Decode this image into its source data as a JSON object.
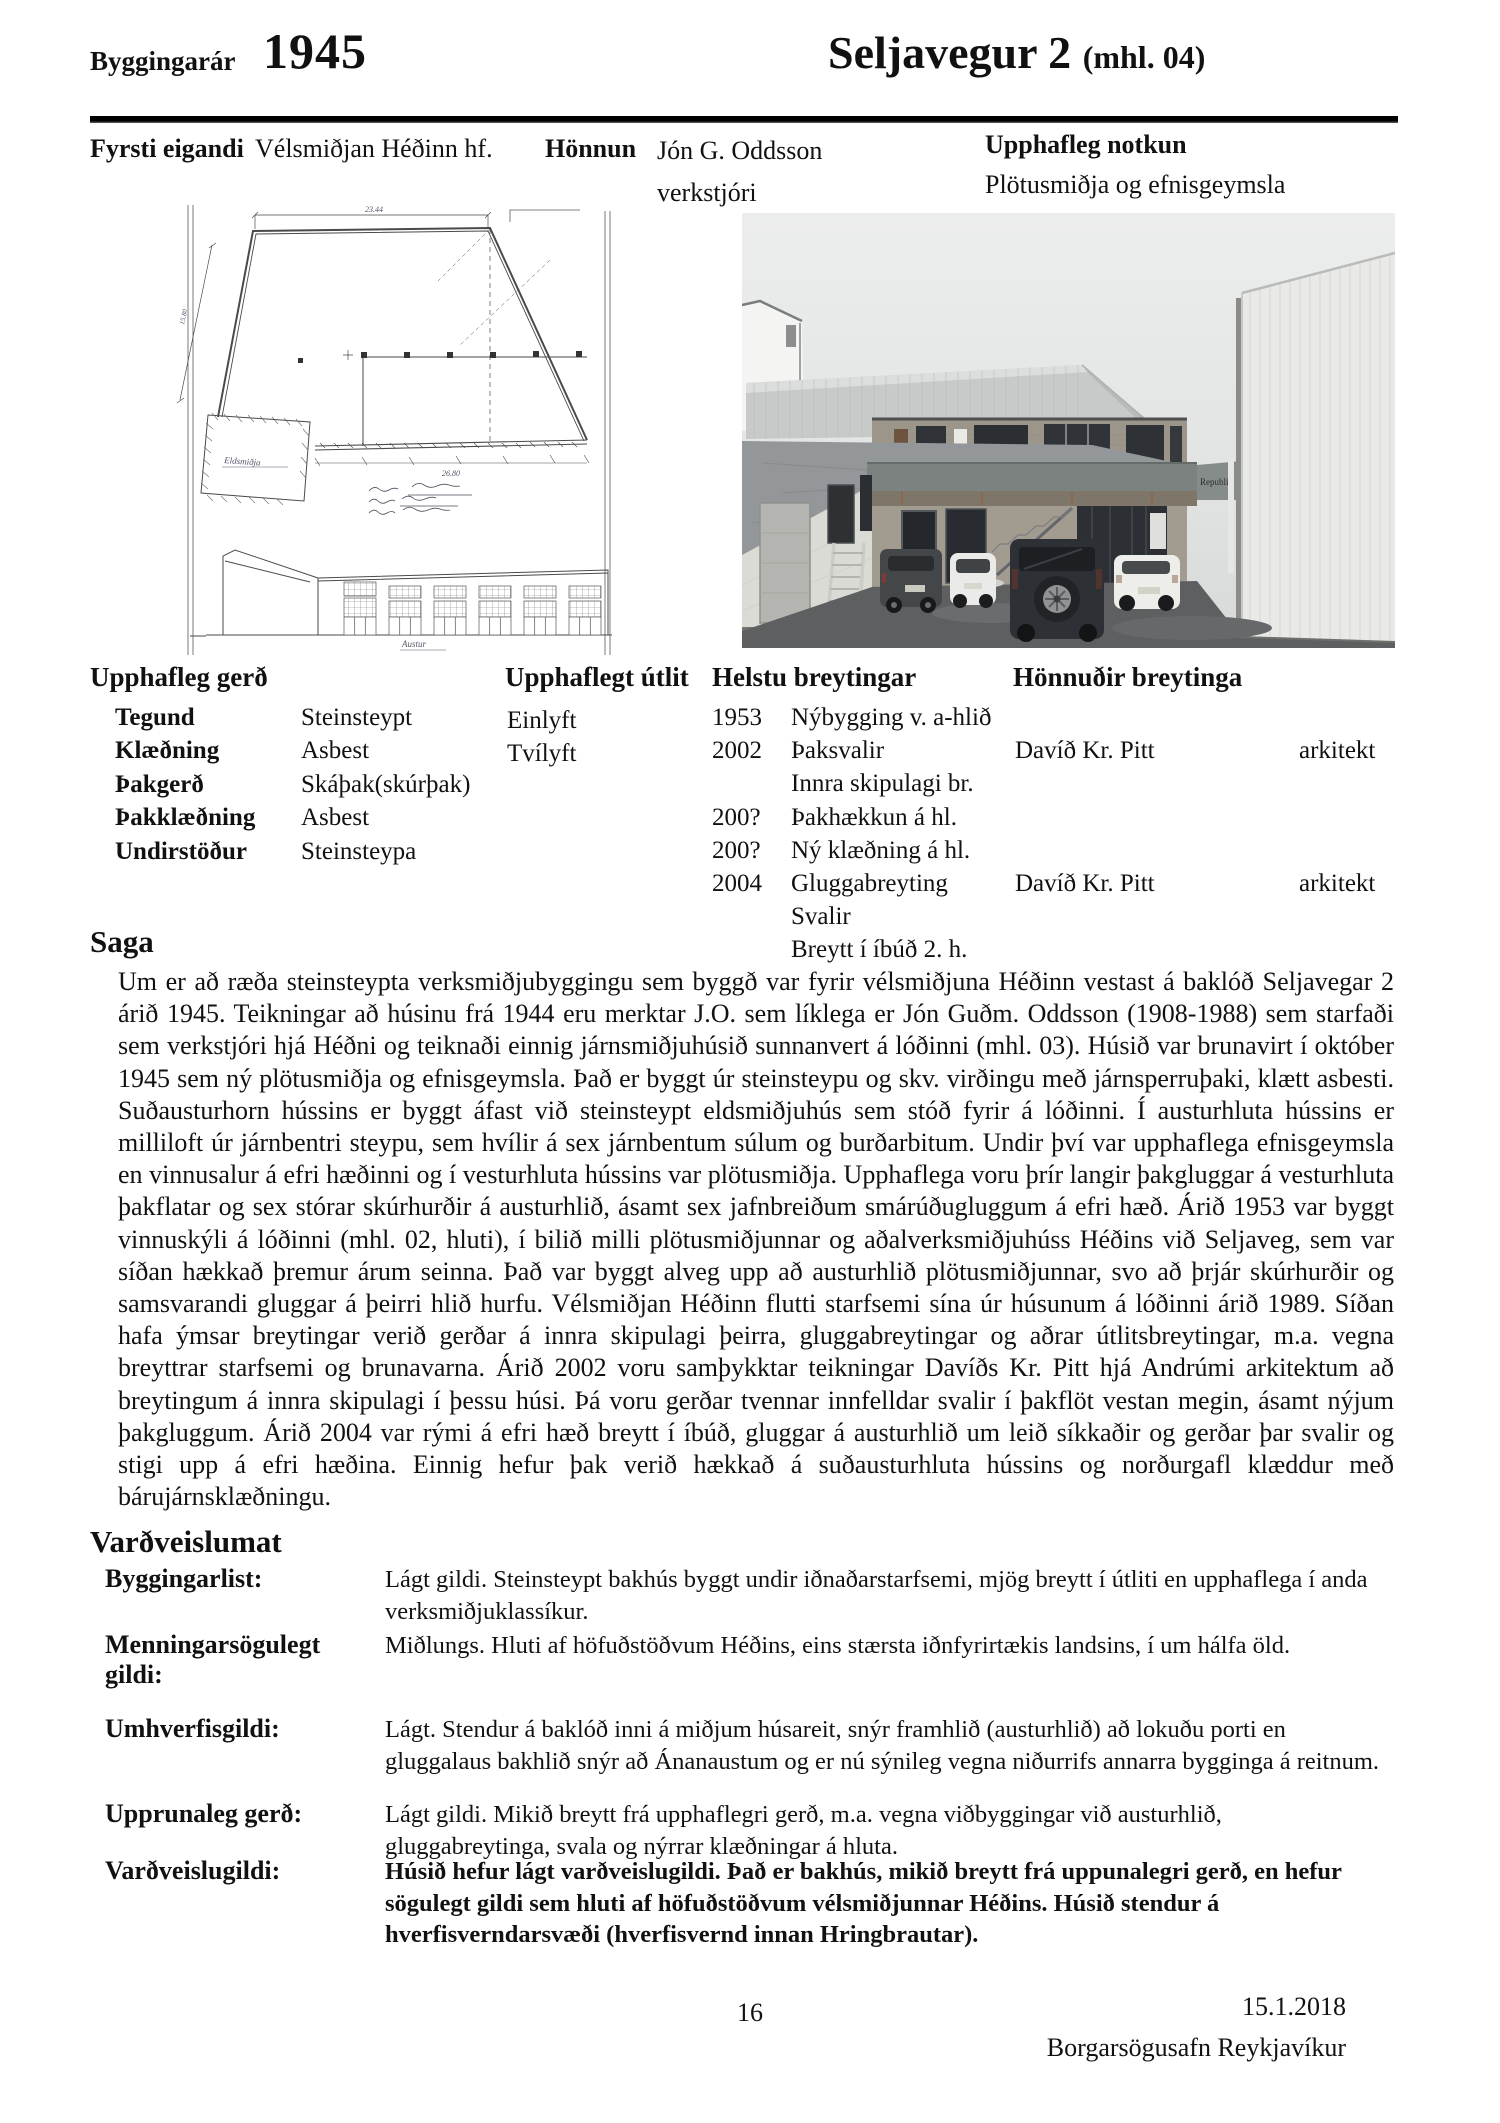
{
  "header": {
    "year_label": "Byggingarár",
    "year": "1945",
    "title": "Seljavegur 2",
    "title_suffix": "(mhl. 04)"
  },
  "info_row": {
    "first_owner_label": "Fyrsti eigandi",
    "first_owner": "Vélsmiðjan Héðinn hf.",
    "design_label": "Hönnun",
    "designer": "Jón G. Oddsson",
    "designer_title": "verkstjóri",
    "original_use_label": "Upphafleg notkun",
    "original_use": "Plötusmiðja og efnisgeymsla"
  },
  "media": {
    "drawing": {
      "top_dimension": "23.44",
      "bottom_dimension": "26.80",
      "side_dimension": "15.80",
      "smithy_label": "Eldsmiðja",
      "elevation_label": "Austur"
    },
    "photo": {
      "sign_text": "Republik"
    }
  },
  "original_form": {
    "heading": "Upphafleg gerð",
    "fields": [
      {
        "label": "Tegund",
        "value": "Steinsteypt"
      },
      {
        "label": "Klæðning",
        "value": "Asbest"
      },
      {
        "label": "Þakgerð",
        "value": "Skáþak(skúrþak)"
      },
      {
        "label": "Þakklæðning",
        "value": "Asbest"
      },
      {
        "label": "Undirstöður",
        "value": "Steinsteypa"
      }
    ]
  },
  "original_appearance": {
    "heading": "Upphaflegt útlit",
    "items": [
      "Einlyft",
      "Tvílyft"
    ]
  },
  "main_changes": {
    "heading": "Helstu breytingar",
    "designers_heading": "Hönnuðir breytinga",
    "rows": [
      {
        "year": "1953",
        "change": "Nýbygging v. a-hlið",
        "designer": "",
        "role": ""
      },
      {
        "year": "2002",
        "change": "Þaksvalir",
        "designer": "Davíð Kr. Pitt",
        "role": "arkitekt"
      },
      {
        "year": "",
        "change": "Innra skipulagi br.",
        "designer": "",
        "role": ""
      },
      {
        "year": "200?",
        "change": "Þakhækkun á hl.",
        "designer": "",
        "role": ""
      },
      {
        "year": "200?",
        "change": "Ný klæðning á hl.",
        "designer": "",
        "role": ""
      },
      {
        "year": "2004",
        "change": "Gluggabreyting",
        "designer": "Davíð Kr. Pitt",
        "role": "arkitekt"
      },
      {
        "year": "",
        "change": "Svalir",
        "designer": "",
        "role": ""
      },
      {
        "year": "",
        "change": "Breytt í íbúð 2. h.",
        "designer": "",
        "role": ""
      }
    ]
  },
  "saga": {
    "heading": "Saga",
    "text": "Um er að ræða steinsteypta verksmiðjubyggingu sem byggð var fyrir vélsmiðjuna Héðinn vestast á baklóð Seljavegar 2 árið 1945. Teikningar að húsinu frá 1944 eru merktar J.O. sem líklega er Jón Guðm. Oddsson (1908-1988) sem starfaði sem verkstjóri hjá Héðni og teiknaði einnig járnsmiðjuhúsið sunnanvert á lóðinni (mhl. 03). Húsið var brunavirt í október 1945 sem ný plötusmiðja og efnisgeymsla. Það er byggt úr steinsteypu og skv. virðingu með járnsperruþaki, klætt asbesti. Suðausturhorn hússins er byggt áfast við steinsteypt eldsmiðjuhús sem stóð fyrir á lóðinni. Í austurhluta hússins er milliloft úr járnbentri steypu, sem hvílir á sex járnbentum súlum og burðarbitum. Undir því var upphaflega efnisgeymsla en vinnusalur á efri hæðinni og í vesturhluta hússins var plötusmiðja. Upphaflega voru þrír langir þakgluggar á vesturhluta þakflatar og sex stórar skúrhurðir á austurhlið, ásamt sex jafnbreiðum smárúðugluggum á efri hæð. Árið 1953 var byggt vinnuskýli á lóðinni (mhl. 02, hluti), í bilið milli plötusmiðjunnar og aðalverksmiðjuhúss Héðins við Seljaveg, sem var síðan hækkað þremur árum seinna. Það var byggt alveg upp að austurhlið plötusmiðjunnar, svo að þrjár skúrhurðir og samsvarandi gluggar á þeirri hlið hurfu. Vélsmiðjan Héðinn flutti starfsemi sína úr húsunum á lóðinni árið 1989. Síðan hafa ýmsar breytingar verið gerðar á innra skipulagi þeirra, gluggabreytingar og aðrar útlitsbreytingar, m.a. vegna breyttrar starfsemi og brunavarna. Árið 2002 voru samþykktar teikningar Davíðs Kr. Pitt hjá Andrúmi arkitektum að breytingum á innra skipulagi í þessu húsi. Þá voru gerðar tvennar innfelldar svalir í þakflöt vestan megin, ásamt nýjum þakgluggum. Árið 2004 var rými á efri hæð breytt í íbúð, gluggar á austurhlið um leið síkkaðir og gerðar þar svalir og stigi upp á efri hæðina. Einnig hefur þak verið hækkað á suðausturhluta hússins og norðurgafl klæddur með bárujárnsklæðningu."
  },
  "assessment": {
    "heading": "Varðveislumat",
    "rows": [
      {
        "label": "Byggingarlist:",
        "text": "Lágt gildi. Steinsteypt bakhús byggt undir iðnaðarstarfsemi, mjög breytt í útliti en upphaflega í anda verksmiðjuklassíkur."
      },
      {
        "label": "Menningarsögulegt gildi:",
        "text": "Miðlungs. Hluti af höfuðstöðvum Héðins, eins stærsta iðnfyrirtækis landsins, í um hálfa öld."
      },
      {
        "label": "Umhverfisgildi:",
        "text": "Lágt. Stendur á baklóð inni á miðjum húsareit, snýr framhlið (austurhlið) að lokuðu porti en gluggalaus bakhlið snýr að Ánanaustum og er nú sýnileg vegna niðurrifs annarra bygginga á reitnum."
      },
      {
        "label": "Upprunaleg gerð:",
        "text": "Lágt gildi. Mikið breytt frá upphaflegri gerð, m.a. vegna viðbyggingar við austurhlið, gluggabreytinga, svala og nýrrar klæðningar á hluta."
      },
      {
        "label": "Varðveislugildi:",
        "text": "Húsið hefur lágt varðveislugildi. Það er bakhús, mikið breytt frá uppunalegri gerð, en hefur sögulegt gildi sem hluti af höfuðstöðvum vélsmiðjunnar Héðins. Húsið stendur á hverfisverndarsvæði (hverfisvernd innan Hringbrautar)."
      }
    ]
  },
  "footer": {
    "page_number": "16",
    "date": "15.1.2018",
    "institution": "Borgarsögusafn Reykjavíkur"
  }
}
